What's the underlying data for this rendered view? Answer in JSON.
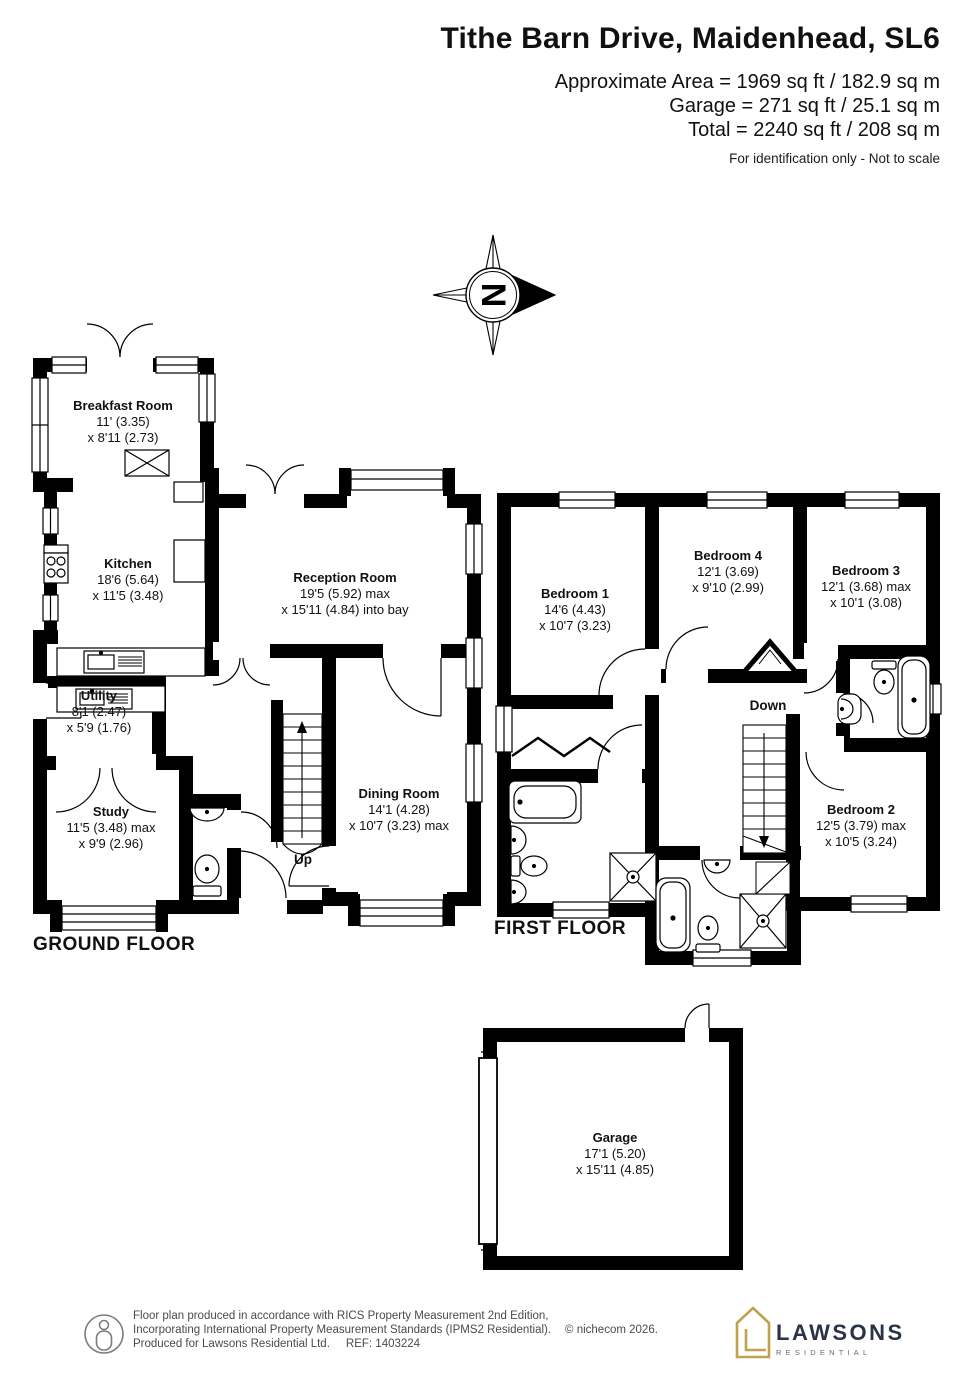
{
  "header": {
    "title": "Tithe Barn Drive, Maidenhead, SL6",
    "area_line1": "Approximate Area = 1969 sq ft / 182.9 sq m",
    "area_line2": "Garage = 271 sq ft / 25.1 sq m",
    "area_line3": "Total = 2240 sq ft / 208 sq m",
    "disclaimer": "For identification only - Not to scale"
  },
  "compass": {
    "letter": "N"
  },
  "floors": {
    "ground": {
      "label": "GROUND FLOOR",
      "stairs": "Up",
      "rooms": {
        "breakfast": {
          "name": "Breakfast Room",
          "dim1": "11' (3.35)",
          "dim2": "x 8'11 (2.73)"
        },
        "kitchen": {
          "name": "Kitchen",
          "dim1": "18'6 (5.64)",
          "dim2": "x 11'5 (3.48)"
        },
        "utility": {
          "name": "Utility",
          "dim1": "8'1 (2.47)",
          "dim2": "x 5'9 (1.76)"
        },
        "study": {
          "name": "Study",
          "dim1": "11'5 (3.48) max",
          "dim2": "x 9'9 (2.96)"
        },
        "reception": {
          "name": "Reception Room",
          "dim1": "19'5 (5.92) max",
          "dim2": "x 15'11 (4.84) into bay"
        },
        "dining": {
          "name": "Dining Room",
          "dim1": "14'1 (4.28)",
          "dim2": "x 10'7 (3.23) max"
        }
      }
    },
    "first": {
      "label": "FIRST FLOOR",
      "stairs": "Down",
      "rooms": {
        "bedroom1": {
          "name": "Bedroom 1",
          "dim1": "14'6 (4.43)",
          "dim2": "x 10'7 (3.23)"
        },
        "bedroom2": {
          "name": "Bedroom 2",
          "dim1": "12'5 (3.79) max",
          "dim2": "x 10'5 (3.24)"
        },
        "bedroom3": {
          "name": "Bedroom 3",
          "dim1": "12'1 (3.68) max",
          "dim2": "x 10'1 (3.08)"
        },
        "bedroom4": {
          "name": "Bedroom 4",
          "dim1": "12'1 (3.69)",
          "dim2": "x 9'10 (2.99)"
        }
      }
    },
    "garage": {
      "rooms": {
        "garage": {
          "name": "Garage",
          "dim1": "17'1 (5.20)",
          "dim2": "x 15'11 (4.85)"
        }
      }
    }
  },
  "footer": {
    "line1": "Floor plan produced in accordance with RICS Property Measurement 2nd Edition,",
    "line2": "Incorporating International Property Measurement Standards (IPMS2 Residential).",
    "copyright": "© nichecom 2026.",
    "line3": "Produced for Lawsons Residential Ltd.",
    "ref": "REF:  1403224",
    "brand": {
      "name": "LAWSONS",
      "tagline": "RESIDENTIAL"
    }
  },
  "colors": {
    "wall": "#000000",
    "brand_gold": "#c2a14d",
    "brand_navy": "#2a3447",
    "footer_gray": "#4b4b4b"
  }
}
